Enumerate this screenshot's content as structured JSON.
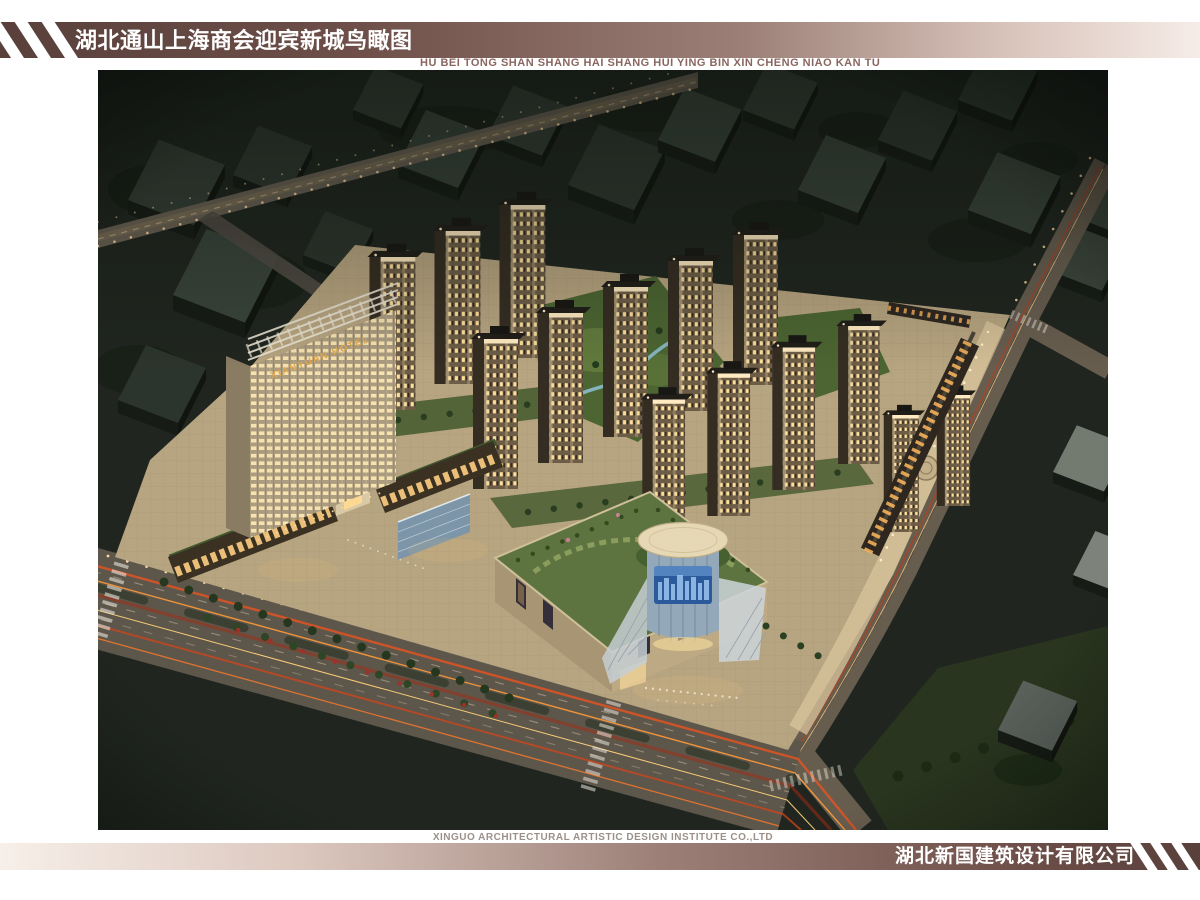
{
  "header": {
    "title": "湖北通山上海商会迎宾新城鸟瞰图",
    "subtitle_pinyin": "HU BEI TONG SHAN SHANG HAI SHANG HUI YING BIN XIN CHENG NIAO KAN TU"
  },
  "footer": {
    "institute_en": "XINGUO ARCHITECTURAL ARTISTIC DESIGN INSTITUTE CO.,LTD",
    "company_cn": "湖北新国建筑设计有限公司"
  },
  "scene": {
    "description": "Night-time aerial (bird's-eye) rendering of the Yingbin New Town mixed-use development: residential towers, hotel, round-atrium shopping mall, lit boulevards with car light trails",
    "hotel_sign": "XIANYUAN HOTEL"
  },
  "colors": {
    "banner_dark": "#5a403c",
    "banner_light": "#f6ece7",
    "banner_stripe": "#ffffff",
    "banner_text": "#ffffff",
    "pinyin_text": "#8a6660",
    "footer_en_text": "#9c918a",
    "night_background": "#20261f",
    "tower_facade": "#c7b693",
    "window_glow": "#ffdf9d",
    "roof_lawn": "#5d7440",
    "light_trail": "#e8541f"
  }
}
